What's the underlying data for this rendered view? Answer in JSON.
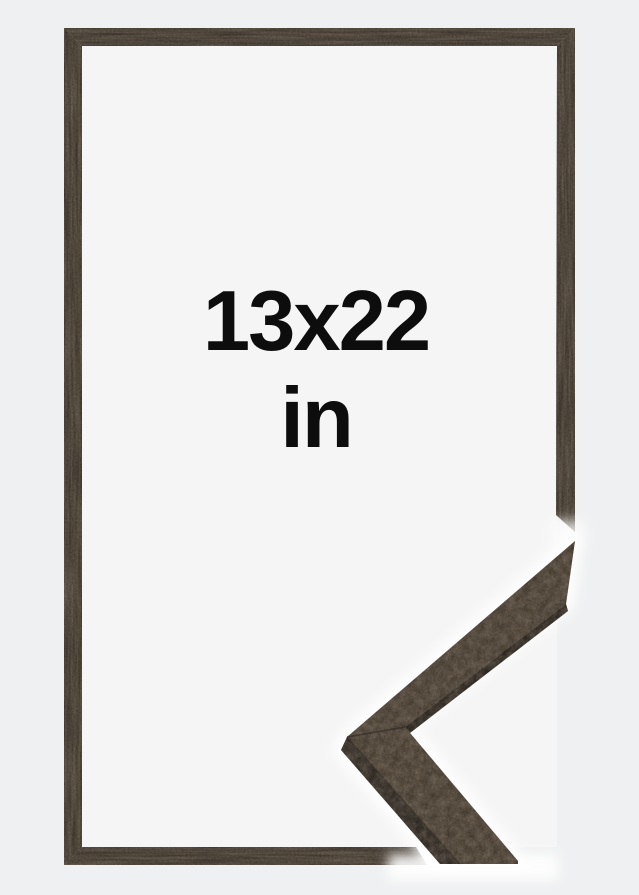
{
  "product_image": {
    "kind": "picture-frame-size-preview",
    "size_label": {
      "line1": "13x22",
      "line2": "in"
    },
    "colors": {
      "background_outer": "#eff0f1",
      "background_inner": "#f5f5f6",
      "wood_base": "#42382e",
      "wood_detail_top": "#4e4235",
      "wood_side_dark": "#2c2620",
      "wood_under_edge": "#27211b",
      "halo_white": "#ffffff",
      "text_color": "#0d0d0d"
    }
  }
}
